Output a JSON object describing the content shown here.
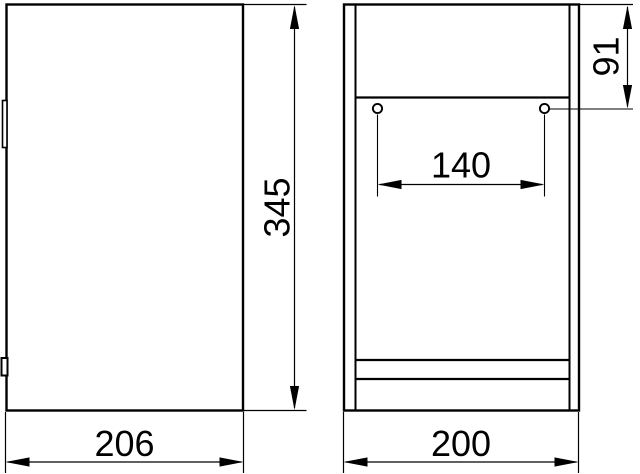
{
  "colors": {
    "background": "#ffffff",
    "line": "#000000",
    "text": "#000000"
  },
  "diagram": {
    "type": "technical-dimension-drawing",
    "views": [
      {
        "id": "side-view",
        "description": "side elevation of cabinet with two door hinges on left edge",
        "height_dim": "345",
        "depth_dim": "206"
      },
      {
        "id": "front-view",
        "description": "front elevation with top panel, two mounting holes and bottom rails",
        "width_dim": "200",
        "hole_spacing_dim": "140",
        "hole_top_offset_dim": "91"
      }
    ]
  }
}
